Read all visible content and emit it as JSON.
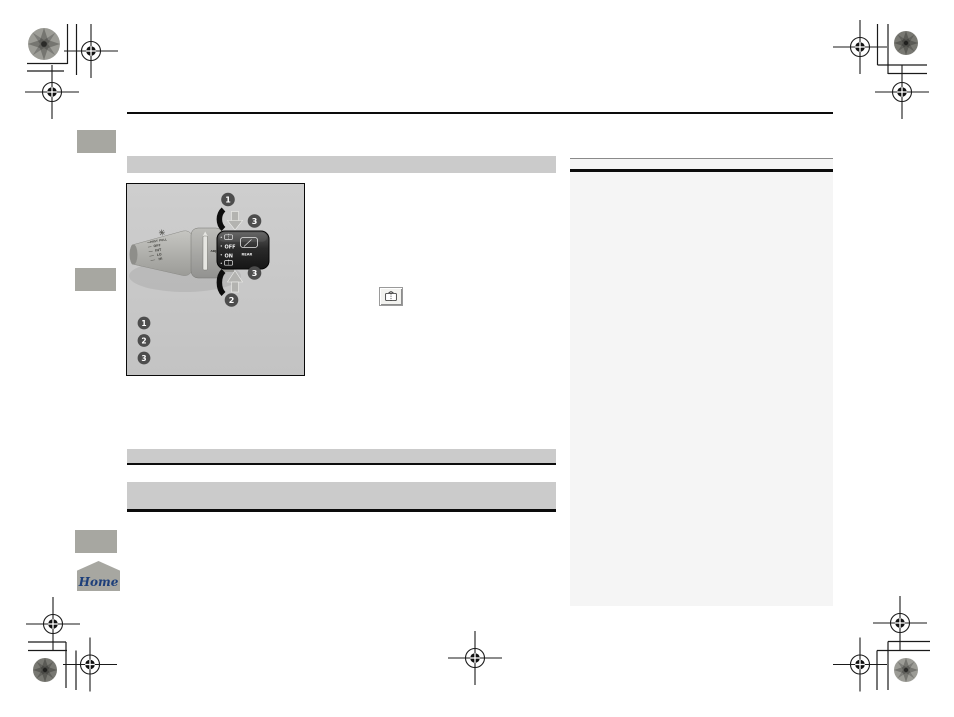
{
  "page": {
    "kind": "owner-manual-page",
    "background": "#ffffff"
  },
  "diagram": {
    "stalk": {
      "mist": "MIST",
      "pull": "PULL",
      "off": "OFF",
      "int": "INT",
      "lo": "LO",
      "hi": "HI",
      "adj": "ADJ"
    },
    "knob": {
      "off": "OFF",
      "on": "ON",
      "rear": "REAR"
    },
    "callouts": {
      "c1": "1",
      "c2": "2",
      "c3": "3"
    },
    "legend": {
      "l1": "1",
      "l2": "2",
      "l3": "3"
    }
  },
  "icons": {
    "inline_button": "rear-window-washer-icon",
    "stalk_tip": "windshield-washer-icon",
    "knob_top": "rear-washer-icon",
    "knob_bottom": "rear-washer-icon",
    "knob_window": "rear-wiper-icon"
  },
  "home": {
    "label": "Home",
    "text_color": "#1d3f7a"
  },
  "colors": {
    "bar_gray": "#cbcbcb",
    "tab_gray": "#a7a7a1",
    "sidebar_bg": "#f5f5f5",
    "diagram_bg": "#cacaca",
    "knob_dark": "#2e2e2e",
    "badge_gray": "#4d4d4d",
    "rule_black": "#0c0c0c"
  }
}
